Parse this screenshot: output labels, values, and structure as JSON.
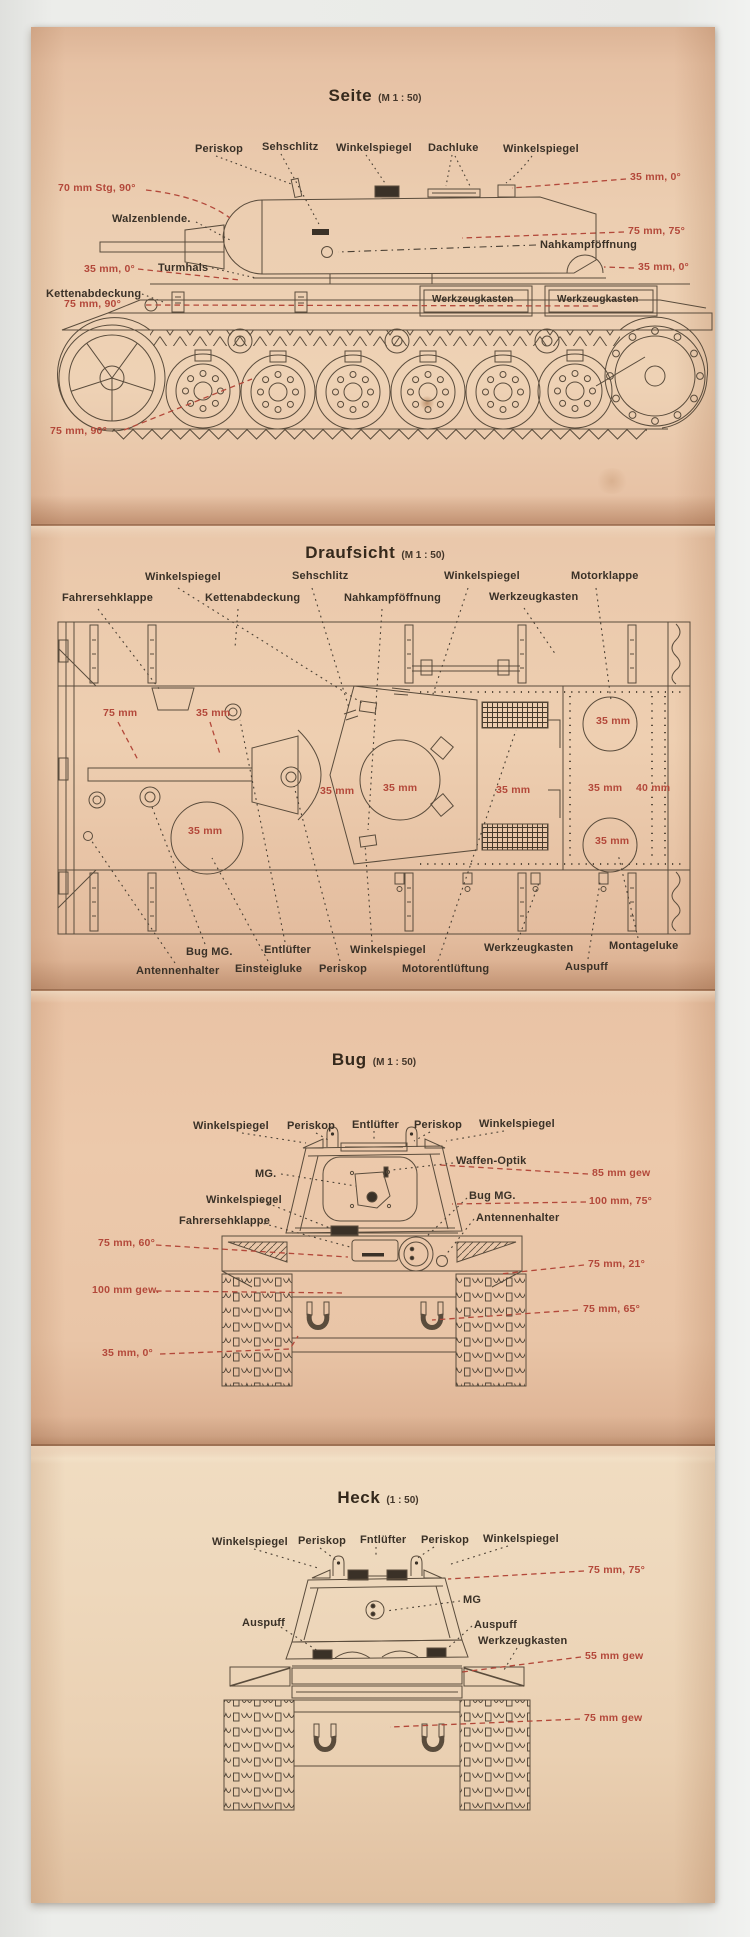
{
  "colors": {
    "background": "#e9eae7",
    "paper": "#ecc9ab",
    "red": "#b3483a",
    "ink": "#3a3127"
  },
  "panels": [
    {
      "id": "seite",
      "title": {
        "main": "Seite",
        "scale": "(M 1 : 50)"
      },
      "labels": [
        {
          "t": "Periskop",
          "x": 195,
          "y": 143,
          "c": "ink"
        },
        {
          "t": "Sehschlitz",
          "x": 262,
          "y": 141,
          "c": "ink"
        },
        {
          "t": "Winkelspiegel",
          "x": 336,
          "y": 142,
          "c": "ink"
        },
        {
          "t": "Dachluke",
          "x": 428,
          "y": 142,
          "c": "ink"
        },
        {
          "t": "Winkelspiegel",
          "x": 503,
          "y": 143,
          "c": "ink"
        },
        {
          "t": "35 mm, 0°",
          "x": 630,
          "y": 172,
          "c": "red"
        },
        {
          "t": "70 mm Stg, 90°",
          "x": 58,
          "y": 183,
          "c": "red"
        },
        {
          "t": "Walzenblende.",
          "x": 112,
          "y": 213,
          "c": "ink"
        },
        {
          "t": "75 mm, 75°",
          "x": 628,
          "y": 226,
          "c": "red"
        },
        {
          "t": "Nahkampföffnung",
          "x": 540,
          "y": 239,
          "c": "ink"
        },
        {
          "t": "35 mm, 0°",
          "x": 84,
          "y": 264,
          "c": "red"
        },
        {
          "t": "Turmhals",
          "x": 158,
          "y": 262,
          "c": "ink"
        },
        {
          "t": "35 mm, 0°",
          "x": 638,
          "y": 262,
          "c": "red"
        },
        {
          "t": "Kettenabdeckung",
          "x": 46,
          "y": 288,
          "c": "ink"
        },
        {
          "t": "75 mm, 90°",
          "x": 64,
          "y": 299,
          "c": "red"
        },
        {
          "t": "Werkzeugkasten",
          "x": 432,
          "y": 294,
          "c": "ink",
          "fs": 10
        },
        {
          "t": "Werkzeugkasten",
          "x": 557,
          "y": 294,
          "c": "ink",
          "fs": 10
        },
        {
          "t": "75 mm, 90°",
          "x": 50,
          "y": 426,
          "c": "red"
        }
      ]
    },
    {
      "id": "draufsicht",
      "title": {
        "main": "Draufsicht",
        "scale": "(M 1 : 50)"
      },
      "labels": [
        {
          "t": "Winkelspiegel",
          "x": 145,
          "y": 571,
          "c": "ink"
        },
        {
          "t": "Sehschlitz",
          "x": 292,
          "y": 570,
          "c": "ink"
        },
        {
          "t": "Winkelspiegel",
          "x": 444,
          "y": 570,
          "c": "ink"
        },
        {
          "t": "Motorklappe",
          "x": 571,
          "y": 570,
          "c": "ink"
        },
        {
          "t": "Fahrersehklappe",
          "x": 62,
          "y": 592,
          "c": "ink"
        },
        {
          "t": "Kettenabdeckung",
          "x": 205,
          "y": 592,
          "c": "ink"
        },
        {
          "t": "Nahkampföffnung",
          "x": 344,
          "y": 592,
          "c": "ink"
        },
        {
          "t": "Werkzeugkasten",
          "x": 489,
          "y": 591,
          "c": "ink"
        },
        {
          "t": "75 mm",
          "x": 103,
          "y": 708,
          "c": "red"
        },
        {
          "t": "35 mm",
          "x": 196,
          "y": 708,
          "c": "red"
        },
        {
          "t": "35 mm",
          "x": 596,
          "y": 716,
          "c": "red"
        },
        {
          "t": "35 mm",
          "x": 320,
          "y": 786,
          "c": "red"
        },
        {
          "t": "35 mm",
          "x": 383,
          "y": 783,
          "c": "red"
        },
        {
          "t": "35 mm",
          "x": 496,
          "y": 785,
          "c": "red"
        },
        {
          "t": "35 mm",
          "x": 588,
          "y": 783,
          "c": "red"
        },
        {
          "t": "40 mm",
          "x": 636,
          "y": 783,
          "c": "red"
        },
        {
          "t": "35 mm",
          "x": 188,
          "y": 826,
          "c": "red"
        },
        {
          "t": "35 mm",
          "x": 595,
          "y": 836,
          "c": "red"
        },
        {
          "t": "Bug MG.",
          "x": 186,
          "y": 946,
          "c": "ink"
        },
        {
          "t": "Entlüfter",
          "x": 264,
          "y": 944,
          "c": "ink"
        },
        {
          "t": "Winkelspiegel",
          "x": 350,
          "y": 944,
          "c": "ink"
        },
        {
          "t": "Werkzeugkasten",
          "x": 484,
          "y": 942,
          "c": "ink"
        },
        {
          "t": "Montageluke",
          "x": 609,
          "y": 940,
          "c": "ink"
        },
        {
          "t": "Antennenhalter",
          "x": 136,
          "y": 965,
          "c": "ink"
        },
        {
          "t": "Einsteigluke",
          "x": 235,
          "y": 963,
          "c": "ink"
        },
        {
          "t": "Periskop",
          "x": 319,
          "y": 963,
          "c": "ink"
        },
        {
          "t": "Motorentlüftung",
          "x": 402,
          "y": 963,
          "c": "ink"
        },
        {
          "t": "Auspuff",
          "x": 565,
          "y": 961,
          "c": "ink"
        }
      ]
    },
    {
      "id": "bug",
      "title": {
        "main": "Bug",
        "scale": "(M 1 : 50)"
      },
      "labels": [
        {
          "t": "Winkelspiegel",
          "x": 193,
          "y": 1120,
          "c": "ink"
        },
        {
          "t": "Periskop",
          "x": 287,
          "y": 1120,
          "c": "ink"
        },
        {
          "t": "Entlüfter",
          "x": 352,
          "y": 1119,
          "c": "ink"
        },
        {
          "t": "Periskop",
          "x": 414,
          "y": 1119,
          "c": "ink"
        },
        {
          "t": "Winkelspiegel",
          "x": 479,
          "y": 1118,
          "c": "ink"
        },
        {
          "t": "Waffen-Optik",
          "x": 456,
          "y": 1155,
          "c": "ink"
        },
        {
          "t": "MG.",
          "x": 255,
          "y": 1168,
          "c": "ink"
        },
        {
          "t": "85 mm gew",
          "x": 592,
          "y": 1168,
          "c": "red"
        },
        {
          "t": "Winkelspiegel",
          "x": 206,
          "y": 1194,
          "c": "ink"
        },
        {
          "t": "Bug MG.",
          "x": 469,
          "y": 1190,
          "c": "ink"
        },
        {
          "t": "100 mm, 75°",
          "x": 589,
          "y": 1196,
          "c": "red"
        },
        {
          "t": "Fahrersehklappe",
          "x": 179,
          "y": 1215,
          "c": "ink"
        },
        {
          "t": "Antennenhalter",
          "x": 476,
          "y": 1212,
          "c": "ink"
        },
        {
          "t": "75 mm, 60°",
          "x": 98,
          "y": 1238,
          "c": "red"
        },
        {
          "t": "75 mm, 21°",
          "x": 588,
          "y": 1259,
          "c": "red"
        },
        {
          "t": "100 mm gew.",
          "x": 92,
          "y": 1285,
          "c": "red"
        },
        {
          "t": "75 mm, 65°",
          "x": 583,
          "y": 1304,
          "c": "red"
        },
        {
          "t": "35 mm, 0°",
          "x": 102,
          "y": 1348,
          "c": "red"
        }
      ]
    },
    {
      "id": "heck",
      "title": {
        "main": "Heck",
        "scale": "(1 : 50)"
      },
      "labels": [
        {
          "t": "Winkelspiegel",
          "x": 212,
          "y": 1536,
          "c": "ink"
        },
        {
          "t": "Periskop",
          "x": 298,
          "y": 1535,
          "c": "ink"
        },
        {
          "t": "Fntlüfter",
          "x": 360,
          "y": 1534,
          "c": "ink"
        },
        {
          "t": "Periskop",
          "x": 421,
          "y": 1534,
          "c": "ink"
        },
        {
          "t": "Winkelspiegel",
          "x": 483,
          "y": 1533,
          "c": "ink"
        },
        {
          "t": "75 mm, 75°",
          "x": 588,
          "y": 1565,
          "c": "red"
        },
        {
          "t": "MG",
          "x": 463,
          "y": 1594,
          "c": "ink"
        },
        {
          "t": "Auspuff",
          "x": 242,
          "y": 1617,
          "c": "ink"
        },
        {
          "t": "Auspuff",
          "x": 474,
          "y": 1619,
          "c": "ink"
        },
        {
          "t": "Werkzeugkasten",
          "x": 478,
          "y": 1635,
          "c": "ink"
        },
        {
          "t": "55 mm gew",
          "x": 585,
          "y": 1651,
          "c": "red"
        },
        {
          "t": "75 mm gew",
          "x": 584,
          "y": 1713,
          "c": "red"
        }
      ]
    }
  ]
}
